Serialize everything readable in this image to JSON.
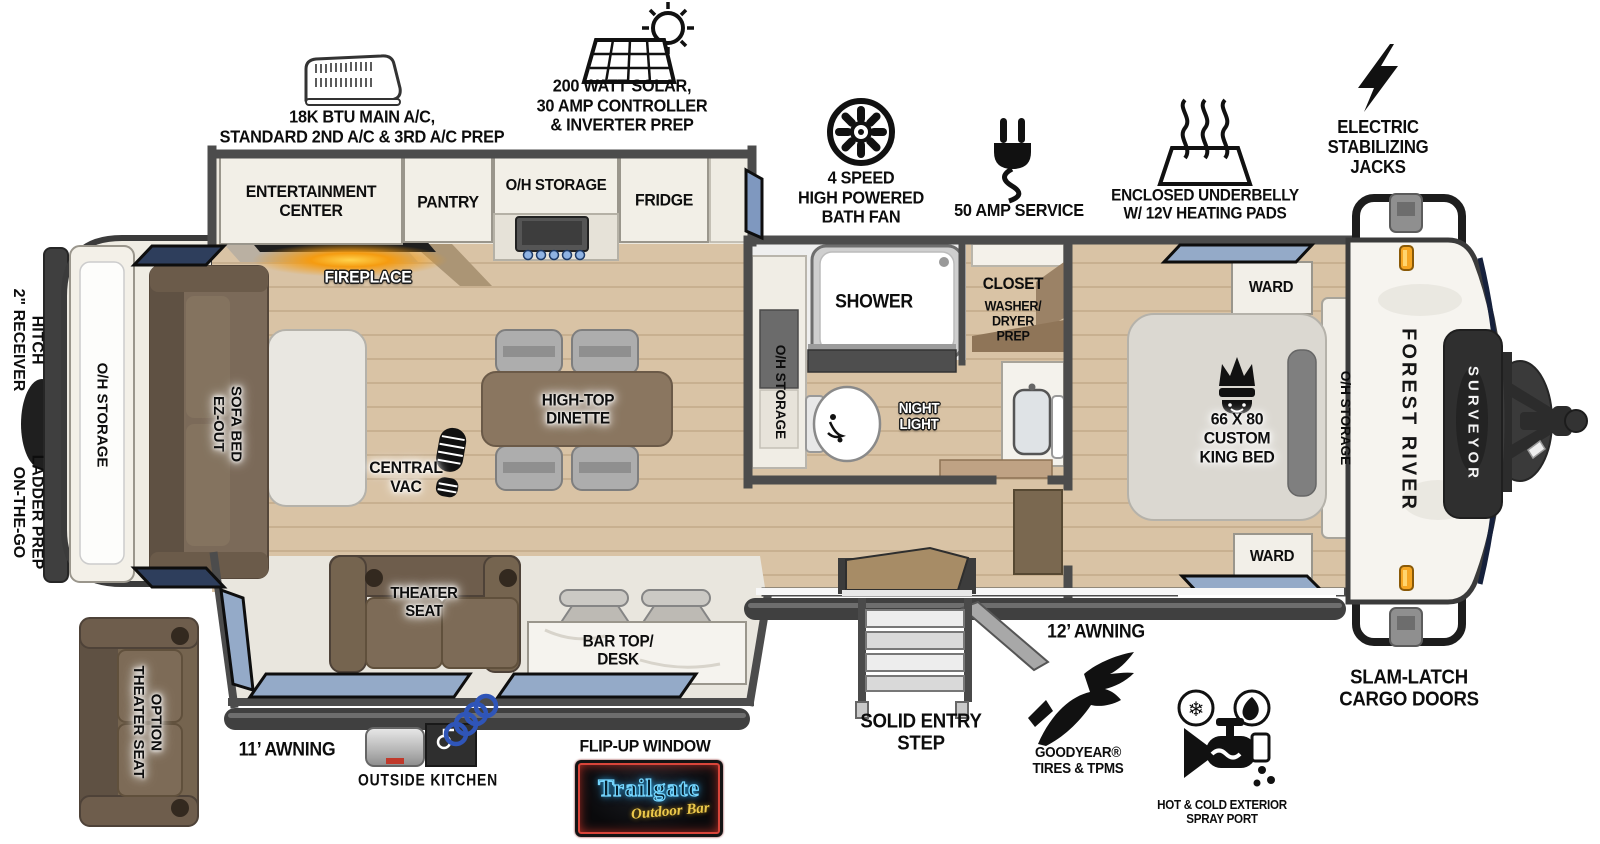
{
  "colors": {
    "wood_floor": "#d9c3a5",
    "wall": "#4c4c4c",
    "window_blue": "#94aac8",
    "window_dark": "#2e3e5c",
    "cabinet_cream": "#f2efe7",
    "sofa_brown": "#7b6a59",
    "table_brown": "#8a7660",
    "marker_orange": "#f5a623",
    "fireplace_glow": "#f39208",
    "neon_blue": "#74d6ff",
    "neon_yellow": "#ecc94b",
    "neon_red": "#d8453a"
  },
  "callouts": {
    "ac": "18K BTU MAIN A/C,\nSTANDARD 2ND A/C & 3RD A/C PREP",
    "solar": "200 WATT SOLAR,\n30 AMP CONTROLLER\n& INVERTER PREP",
    "bath_fan": "4 SPEED\nHIGH POWERED\nBATH FAN",
    "service": "50 AMP SERVICE",
    "underbelly": "ENCLOSED UNDERBELLY\nW/ 12V HEATING PADS",
    "jacks": "ELECTRIC\nSTABILIZING\nJACKS"
  },
  "exterior": {
    "receiver_hitch": "2\" RECEIVER\nHITCH",
    "ladder_prep": "ON-THE-GO\nLADDER PREP"
  },
  "interior": {
    "entertainment": "ENTERTAINMENT\nCENTER",
    "pantry": "PANTRY",
    "oh_storage_kitchen": "O/H STORAGE",
    "fridge": "FRIDGE",
    "fireplace": "FIREPLACE",
    "oh_storage_rear": "O/H STORAGE",
    "sofa_bed": "EZ-OUT\nSOFA BED",
    "dinette": "HIGH-TOP\nDINETTE",
    "central_vac": "CENTRAL\nVAC",
    "oh_storage_bath": "O/H STORAGE",
    "shower": "SHOWER",
    "closet_title": "CLOSET",
    "closet_sub": "WASHER/\nDRYER\nPREP",
    "night_light": "NIGHT\nLIGHT",
    "ward_top": "WARD",
    "ward_bottom": "WARD",
    "king_bed": "66 X 80\nCUSTOM\nKING BED",
    "oh_storage_bed": "O/H STORAGE",
    "theater_seat": "THEATER\nSEAT",
    "bar_desk": "BAR TOP/\nDESK"
  },
  "bottom": {
    "theater_option": "THEATER SEAT\nOPTION",
    "awning_11": "11’ AWNING",
    "outside_kitchen": "OUTSIDE KITCHEN",
    "flip_window": "FLIP-UP WINDOW",
    "solid_step": "SOLID ENTRY\nSTEP",
    "awning_12": "12’ AWNING",
    "goodyear": "GOODYEAR®\nTIRES & TPMS",
    "spray_port": "HOT & COLD EXTERIOR\nSPRAY PORT",
    "slam_latch": "SLAM-LATCH\nCARGO DOORS"
  },
  "branding": {
    "make": "FOREST RIVER",
    "model": "SURVEYOR",
    "logo_title": "Trailgate",
    "logo_sub": "Outdoor Bar"
  }
}
